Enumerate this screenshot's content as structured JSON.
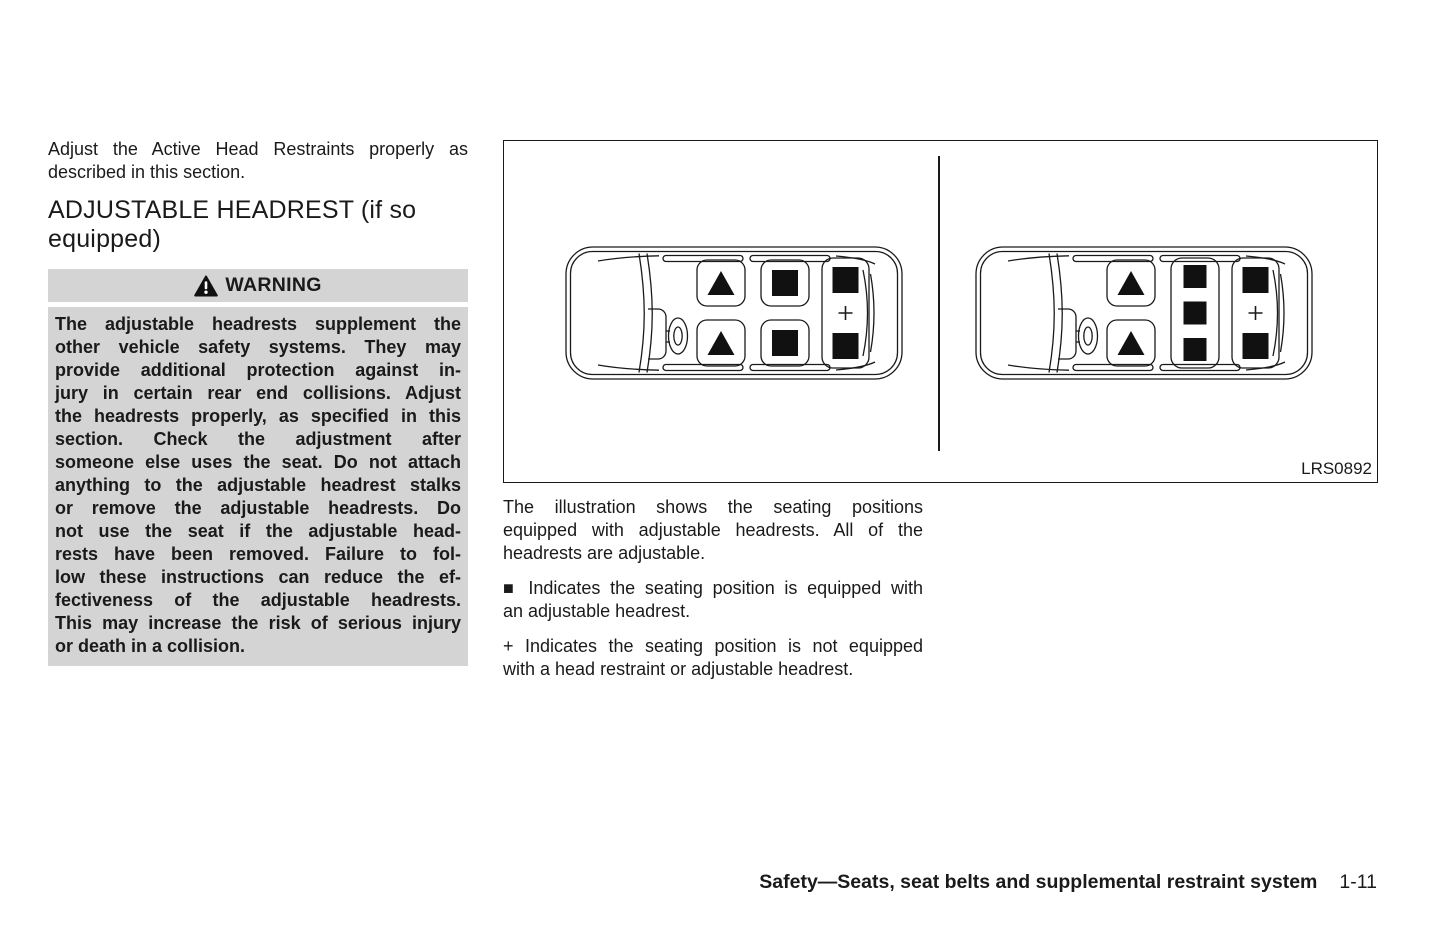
{
  "intro": {
    "lines": [
      "Adjust the Active Head Restraints properly as",
      "described in this section."
    ]
  },
  "heading": {
    "lines": [
      "ADJUSTABLE HEADREST (if so",
      "equipped)"
    ]
  },
  "warning": {
    "title": "WARNING",
    "lines": [
      "The adjustable headrests supplement the",
      "other vehicle safety systems. They may",
      "provide additional protection against in-",
      "jury in certain rear end collisions. Adjust",
      "the headrests properly, as specified in this",
      "section. Check the adjustment after",
      "someone else uses the seat. Do not attach",
      "anything to the adjustable headrest stalks",
      "or remove the adjustable headrests. Do",
      "not use the seat if the adjustable head-",
      "rests have been removed. Failure to fol-",
      "low these instructions can reduce the ef-",
      "fectiveness of the adjustable headrests.",
      "This may increase the risk of serious injury",
      "or death in a collision."
    ]
  },
  "figure": {
    "label": "LRS0892",
    "symbols": {
      "adjustable_headrest": "■",
      "front_seat_marker": "▲",
      "no_headrest": "+"
    }
  },
  "caption": {
    "lines": [
      "The illustration shows the seating positions",
      "equipped with adjustable headrests. All of the",
      "headrests are adjustable."
    ]
  },
  "bullet_square": {
    "lines": [
      "■ Indicates the seating position is equipped with",
      "an adjustable headrest."
    ]
  },
  "bullet_plus": {
    "lines": [
      "+ Indicates the seating position is not equipped",
      "with a head restraint or adjustable headrest."
    ]
  },
  "footer": {
    "title": "Safety—Seats, seat belts and supplemental restraint system",
    "page_number": "1-11"
  },
  "colors": {
    "warning_bg": "#d4d4d4",
    "text": "#1a1a1a"
  }
}
